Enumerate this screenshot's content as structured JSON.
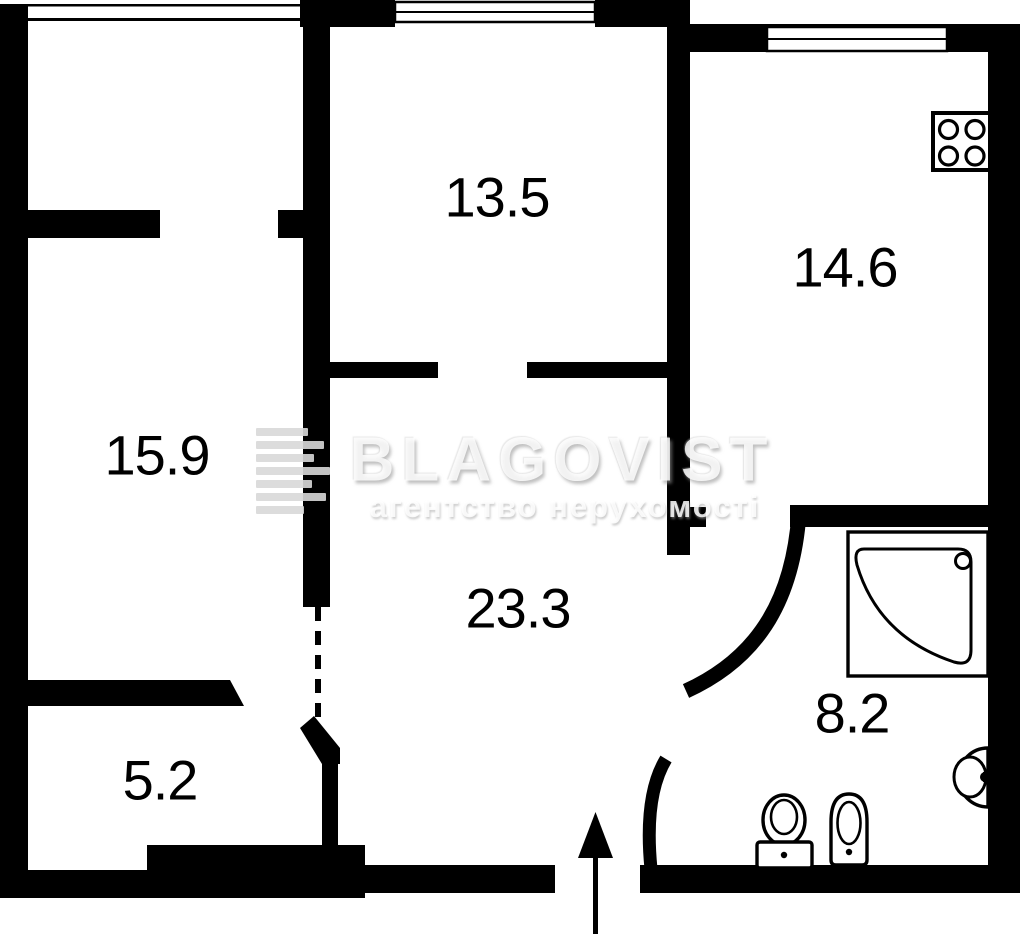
{
  "document": {
    "type": "apartment floor plan",
    "background": "#ffffff"
  },
  "watermark": {
    "brand": "BLAGOVIST",
    "tagline": "агентство нерухомості",
    "logo_icon": "striped-b-logo"
  },
  "rooms": [
    {
      "id": "room-13-5",
      "area_label": "13.5"
    },
    {
      "id": "room-14-6-kitchen",
      "area_label": "14.6"
    },
    {
      "id": "room-15-9",
      "area_label": "15.9"
    },
    {
      "id": "hallway-23-3",
      "area_label": "23.3"
    },
    {
      "id": "room-5-2",
      "area_label": "5.2"
    },
    {
      "id": "bathroom-8-2",
      "area_label": "8.2"
    }
  ],
  "fixtures": {
    "stove": "stove-burners-icon",
    "shower": "corner-shower-icon",
    "sink": "wall-sink-icon",
    "toilet": "toilet-icon",
    "bidet": "bidet-icon",
    "entrance": "entrance-arrow-icon"
  },
  "colors": {
    "wall": "#000000",
    "background": "#ffffff",
    "watermark_gray": "#d8d8d8"
  }
}
